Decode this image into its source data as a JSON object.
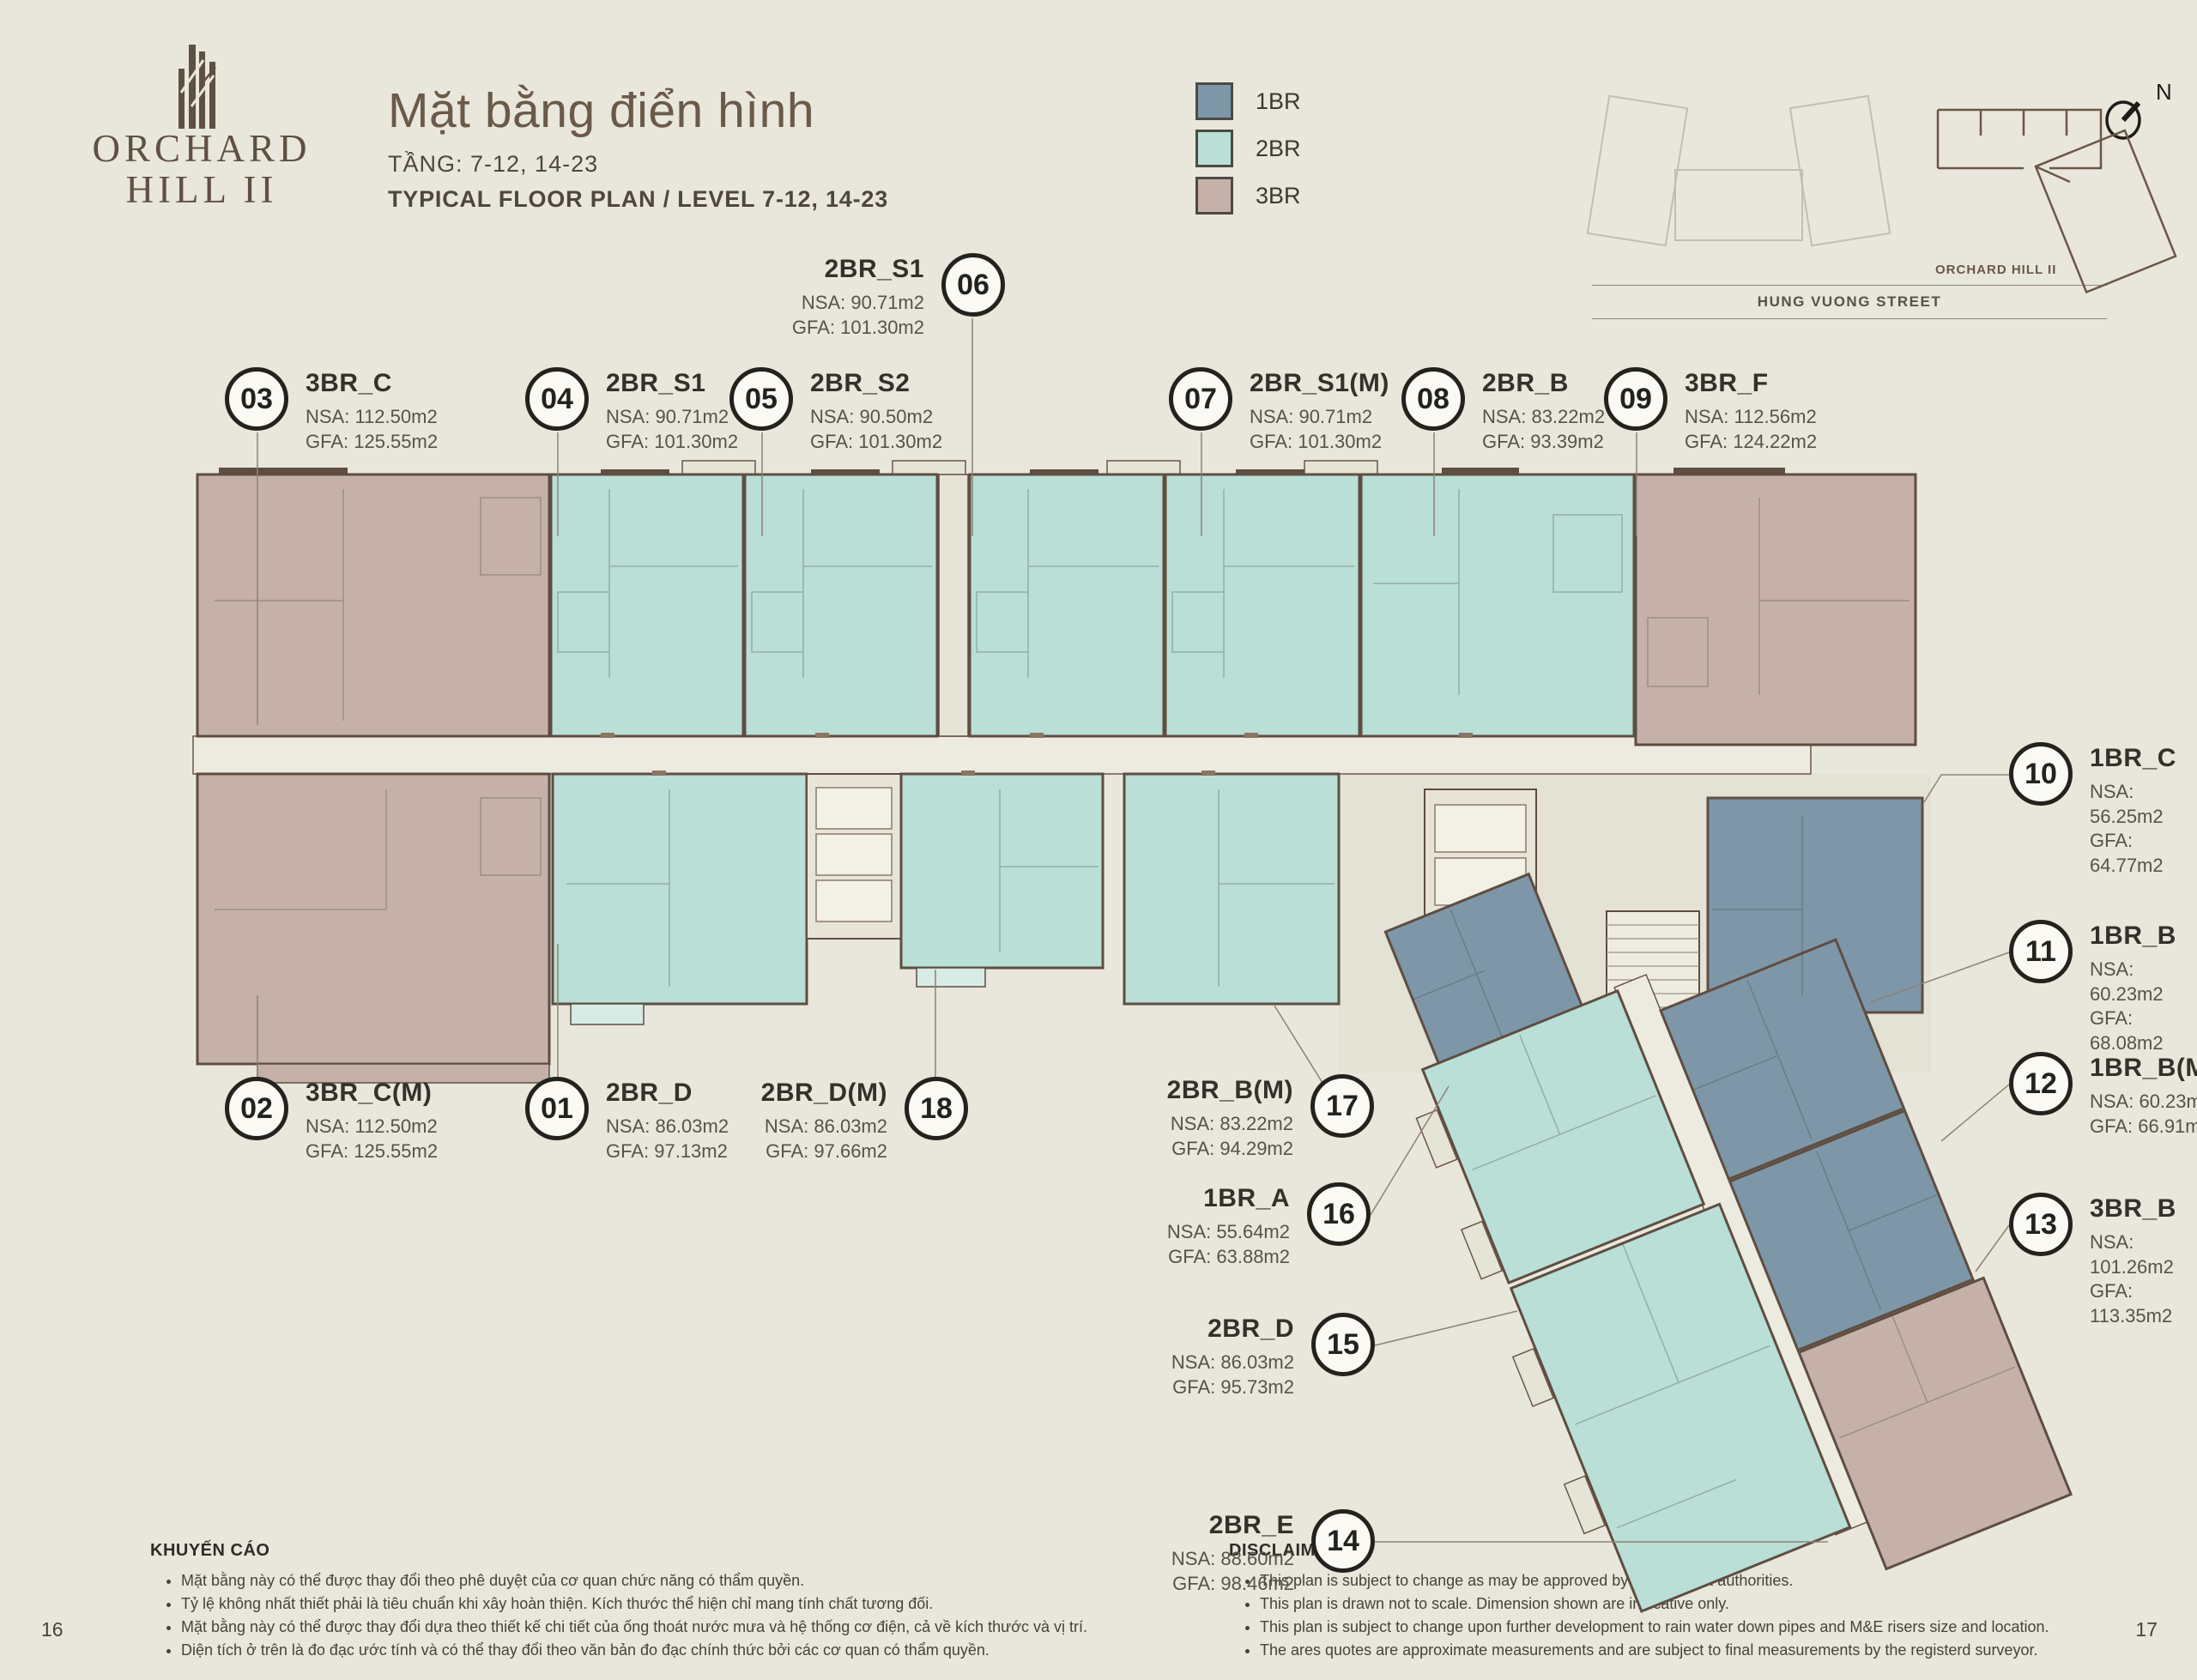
{
  "header": {
    "logo_line1": "ORCHARD",
    "logo_line2": "HILL II",
    "title": "Mặt bằng điển hình",
    "subtitle_vi": "TẦNG: 7-12, 14-23",
    "subtitle_en": "TYPICAL FLOOR PLAN / LEVEL 7-12, 14-23"
  },
  "legend": {
    "items": [
      {
        "label": "1BR",
        "color": "#7d97a9"
      },
      {
        "label": "2BR",
        "color": "#b9dfd7"
      },
      {
        "label": "3BR",
        "color": "#c6b1aa"
      }
    ]
  },
  "key_plan": {
    "building_label": "ORCHARD HILL II",
    "street_label": "HUNG VUONG STREET",
    "north_label": "N"
  },
  "callouts": {
    "c01": {
      "num": "01",
      "type": "2BR_D",
      "nsa": "NSA: 86.03m2",
      "gfa": "GFA: 97.13m2"
    },
    "c02": {
      "num": "02",
      "type": "3BR_C(M)",
      "nsa": "NSA: 112.50m2",
      "gfa": "GFA: 125.55m2"
    },
    "c03": {
      "num": "03",
      "type": "3BR_C",
      "nsa": "NSA: 112.50m2",
      "gfa": "GFA: 125.55m2"
    },
    "c04": {
      "num": "04",
      "type": "2BR_S1",
      "nsa": "NSA: 90.71m2",
      "gfa": "GFA: 101.30m2"
    },
    "c05": {
      "num": "05",
      "type": "2BR_S2",
      "nsa": "NSA: 90.50m2",
      "gfa": "GFA: 101.30m2"
    },
    "c06": {
      "num": "06",
      "type": "2BR_S1",
      "nsa": "NSA: 90.71m2",
      "gfa": "GFA: 101.30m2"
    },
    "c07": {
      "num": "07",
      "type": "2BR_S1(M)",
      "nsa": "NSA: 90.71m2",
      "gfa": "GFA: 101.30m2"
    },
    "c08": {
      "num": "08",
      "type": "2BR_B",
      "nsa": "NSA: 83.22m2",
      "gfa": "GFA: 93.39m2"
    },
    "c09": {
      "num": "09",
      "type": "3BR_F",
      "nsa": "NSA: 112.56m2",
      "gfa": "GFA: 124.22m2"
    },
    "c10": {
      "num": "10",
      "type": "1BR_C",
      "nsa": "NSA: 56.25m2",
      "gfa": "GFA: 64.77m2"
    },
    "c11": {
      "num": "11",
      "type": "1BR_B",
      "nsa": "NSA: 60.23m2",
      "gfa": "GFA: 68.08m2"
    },
    "c12": {
      "num": "12",
      "type": "1BR_B(M)",
      "nsa": "NSA: 60.23m2",
      "gfa": "GFA: 66.91m2"
    },
    "c13": {
      "num": "13",
      "type": "3BR_B",
      "nsa": "NSA: 101.26m2",
      "gfa": "GFA: 113.35m2"
    },
    "c14": {
      "num": "14",
      "type": "2BR_E",
      "nsa": "NSA: 88.60m2",
      "gfa": "GFA: 98.46m2"
    },
    "c15": {
      "num": "15",
      "type": "2BR_D",
      "nsa": "NSA: 86.03m2",
      "gfa": "GFA: 95.73m2"
    },
    "c16": {
      "num": "16",
      "type": "1BR_A",
      "nsa": "NSA: 55.64m2",
      "gfa": "GFA: 63.88m2"
    },
    "c17": {
      "num": "17",
      "type": "2BR_B(M)",
      "nsa": "NSA: 83.22m2",
      "gfa": "GFA: 94.29m2"
    },
    "c18": {
      "num": "18",
      "type": "2BR_D(M)",
      "nsa": "NSA: 86.03m2",
      "gfa": "GFA: 97.66m2"
    }
  },
  "advisory": {
    "title": "KHUYẾN CÁO",
    "bullets": [
      "Mặt bằng này có thể được thay đổi theo phê duyệt của cơ quan chức năng có thẩm quyền.",
      "Tỷ lệ không nhất thiết phải là tiêu chuẩn khi xây hoàn thiện. Kích thước thể hiện chỉ mang tính chất tương đối.",
      "Mặt bằng này có thể được thay đổi dựa theo thiết kế chi tiết của ống thoát nước mưa và hệ thống cơ điện, cả về kích thước và vị trí.",
      "Diện tích ở trên là đo đạc ước tính và có thể thay đổi theo văn bản đo đạc chính thức bởi các cơ quan có thẩm quyền."
    ]
  },
  "disclaimer": {
    "title": "DISCLAIMER",
    "bullets": [
      "This plan is subject to change as may be approved by the relevant authorities.",
      "This plan is drawn not to scale. Dimension shown are indicative only.",
      "This plan is subject to change upon further development to rain water down pipes and M&E risers size and location.",
      "The ares quotes are approximate measurements and are subject to final measurements by the registerd surveyor."
    ]
  },
  "pages": {
    "left": "16",
    "right": "17"
  }
}
